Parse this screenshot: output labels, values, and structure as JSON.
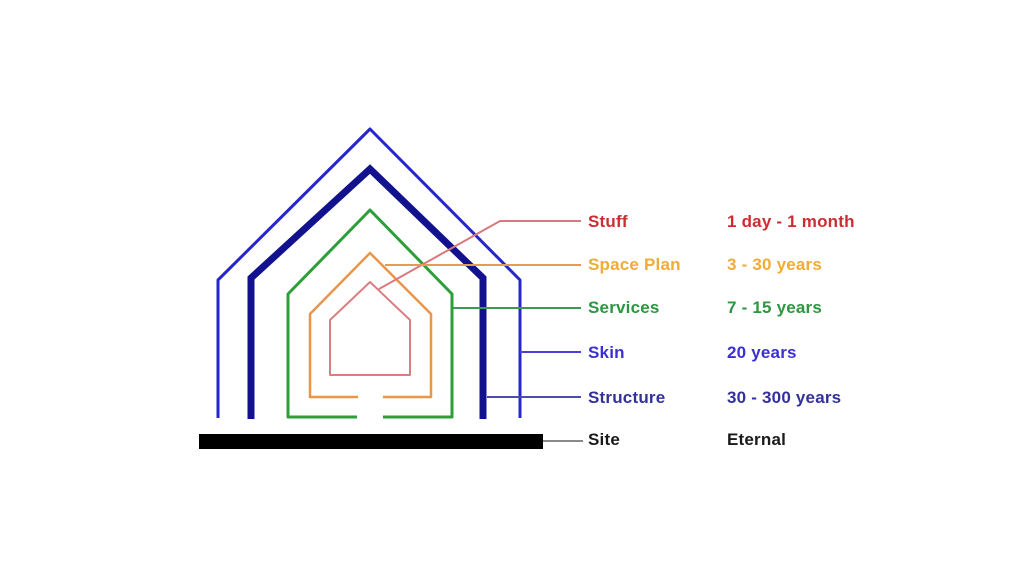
{
  "diagram": {
    "title": "Shearing layers of a building (nested house diagram)",
    "layers": [
      {
        "name": "Stuff",
        "duration": "1 day - 1 month",
        "text_color": "#cc2d32",
        "line_color": "#d97f82",
        "leader_color": "#d8797d"
      },
      {
        "name": "Space Plan",
        "duration": "3 - 30 years",
        "text_color": "#f0ab38",
        "line_color": "#e8964a",
        "leader_color": "#e89a4f"
      },
      {
        "name": "Services",
        "duration": "7 - 15 years",
        "text_color": "#2d9640",
        "line_color": "#2d9e3a",
        "leader_color": "#3a9a55"
      },
      {
        "name": "Skin",
        "duration": "20 years",
        "text_color": "#3a31d0",
        "line_color": "#2626cc",
        "leader_color": "#4a3fd6"
      },
      {
        "name": "Structure",
        "duration": "30 - 300 years",
        "text_color": "#34309c",
        "line_color": "#12128e",
        "leader_color": "#4b4bb0"
      },
      {
        "name": "Site",
        "duration": "Eternal",
        "text_color": "#1a1a1a",
        "line_color": "#000000",
        "leader_color": "#8a8a8a"
      }
    ]
  }
}
